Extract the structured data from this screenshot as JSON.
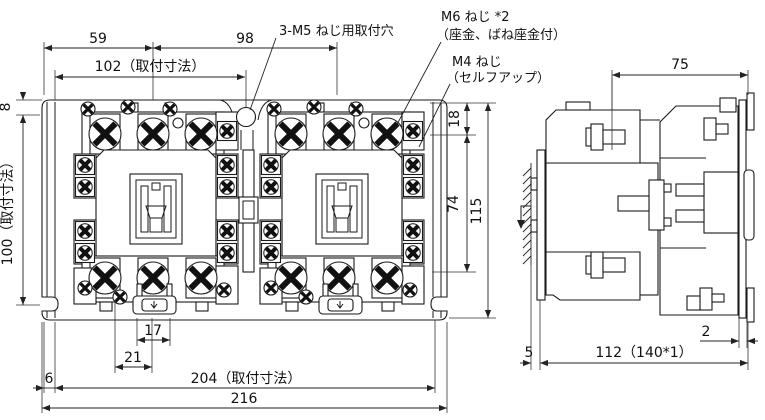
{
  "drawing": {
    "kind": "outline-dimension-drawing",
    "background": "#ffffff",
    "line_color": "#1a1a1a"
  },
  "notes": {
    "mount_hole": "3-M5 ねじ用取付穴",
    "m6_line1": "M6 ねじ *2",
    "m6_line2": "（座金、ばね座金付）",
    "m4_line1": "M4 ねじ",
    "m4_line2": "（セルフアップ）"
  },
  "front_dims": {
    "d59": "59",
    "d98": "98",
    "d102": "102（取付寸法）",
    "d8": "8",
    "d100": "100（取付寸法）",
    "d18": "18",
    "d74": "74",
    "d115": "115",
    "d17": "17",
    "d21": "21",
    "d6": "6",
    "d204": "204（取付寸法）",
    "d216": "216"
  },
  "side_dims": {
    "d75": "75",
    "d5": "5",
    "d112": "112（140*1）",
    "d2": "2"
  }
}
